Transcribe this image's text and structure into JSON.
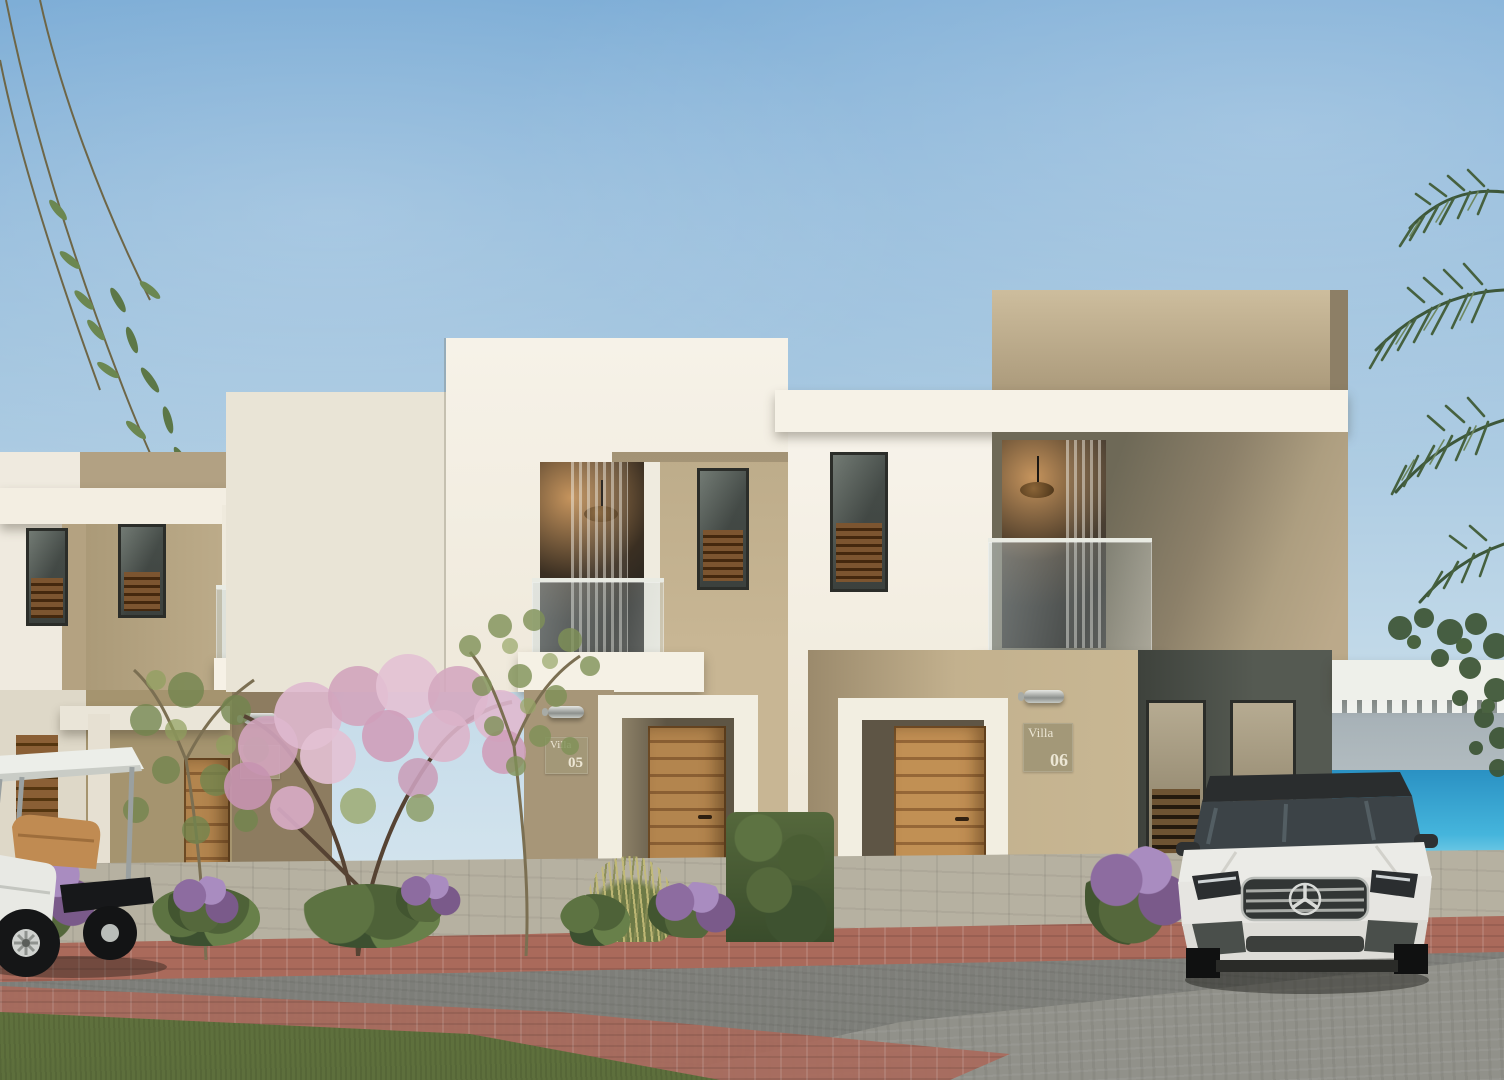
{
  "signs": {
    "villa05": {
      "label": "Villa",
      "number": "05"
    },
    "villa06": {
      "label": "Villa",
      "number": "06"
    }
  },
  "palette": {
    "sky_top": "#7dadd6",
    "sky_horizon": "#e2edf2",
    "wall_white": "#f4f0e6",
    "wall_beige": "#c2b190",
    "wall_olive": "#6e6957",
    "wall_dark_recess": "#4a4e48",
    "wood_door": "#a9793f",
    "sea_blue": "#2f9fce",
    "lawn_green": "#6d7d45",
    "road_gray": "#84847f",
    "brick_red": "#a96a5c",
    "blossom_pink": "#d9aec6",
    "car_white": "#e9e9e5"
  }
}
